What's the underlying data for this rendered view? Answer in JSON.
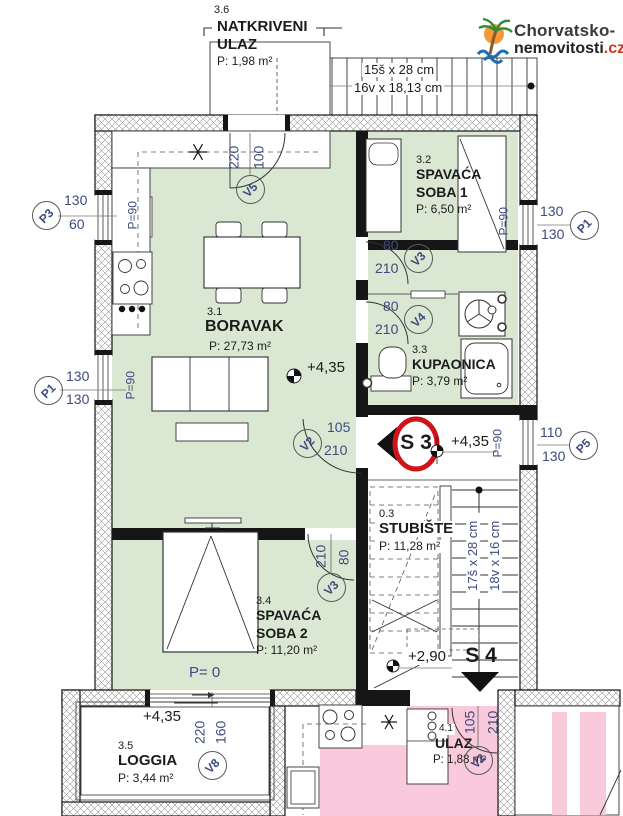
{
  "logo": {
    "line1": "Chorvatsko-",
    "line2": "nemovitosti",
    "tld": ".cz"
  },
  "canopy": {
    "num": "3.6",
    "title1": "NATKRIVENI",
    "title2": "ULAZ",
    "area": "P: 1,98 m²"
  },
  "ext_stairs": {
    "dim1": "15š x 28 cm",
    "dim2": "16v x 18,13 cm"
  },
  "rooms": {
    "boravak": {
      "num": "3.1",
      "name": "BORAVAK",
      "area": "P: 27,73 m²",
      "elevation": "+4,35"
    },
    "soba1": {
      "num": "3.2",
      "name1": "SPAVAĆA",
      "name2": "SOBA 1",
      "area": "P: 6,50 m²"
    },
    "kupaonica": {
      "num": "3.3",
      "name": "KUPAONICA",
      "area": "P: 3,79 m²"
    },
    "soba2": {
      "num": "3.4",
      "name1": "SPAVAĆA",
      "name2": "SOBA 2",
      "area": "P: 11,20 m²",
      "floor_note": "P= 0"
    },
    "loggia": {
      "num": "3.5",
      "name": "LOGGIA",
      "area": "P: 3,44 m²",
      "elevation": "+4,35"
    },
    "stubiste": {
      "num": "0.3",
      "name": "STUBIŠTE",
      "area": "P: 11,28 m²",
      "dim1": "17š x 28 cm",
      "dim2": "18v x 16 cm",
      "elevation": "+2,90"
    },
    "ulaz": {
      "num": "4.1",
      "name": "ULAZ",
      "area": "P: 1,88 m²"
    }
  },
  "landing": {
    "sign": "S 3",
    "elevation": "+4,35"
  },
  "sign_s4": "S 4",
  "windows": {
    "p3": {
      "label": "P3",
      "top": "130",
      "bottom": "60",
      "parapet": "P=90"
    },
    "p1_left": {
      "label": "P1",
      "top": "130",
      "bottom": "130",
      "parapet": "P=90"
    },
    "p1_right": {
      "label": "P1",
      "top": "130",
      "bottom": "130",
      "parapet": "P=90"
    },
    "p5": {
      "label": "P5",
      "top": "110",
      "bottom": "130",
      "parapet": "P=90"
    }
  },
  "doors": {
    "v5": {
      "label": "V5",
      "w": "100",
      "h": "220"
    },
    "v3_hall": {
      "label": "V3",
      "w": "80",
      "h": "210"
    },
    "v4": {
      "label": "V4",
      "w": "80",
      "h": "210"
    },
    "v2_living": {
      "label": "V2",
      "w": "105",
      "h": "210"
    },
    "v3_soba2": {
      "label": "V3",
      "w": "80",
      "h": "210"
    },
    "v8": {
      "label": "V8",
      "w": "160",
      "h": "220"
    },
    "v2_ulaz": {
      "label": "V2",
      "w": "105",
      "h": "210"
    }
  },
  "colors": {
    "room_green": "#d9e7d3",
    "room_pink": "#f9c9dc",
    "dim_blue": "#3d4b7e",
    "sign_red": "#cf1318",
    "tld_red": "#c63a1f",
    "wall": "#161616"
  }
}
